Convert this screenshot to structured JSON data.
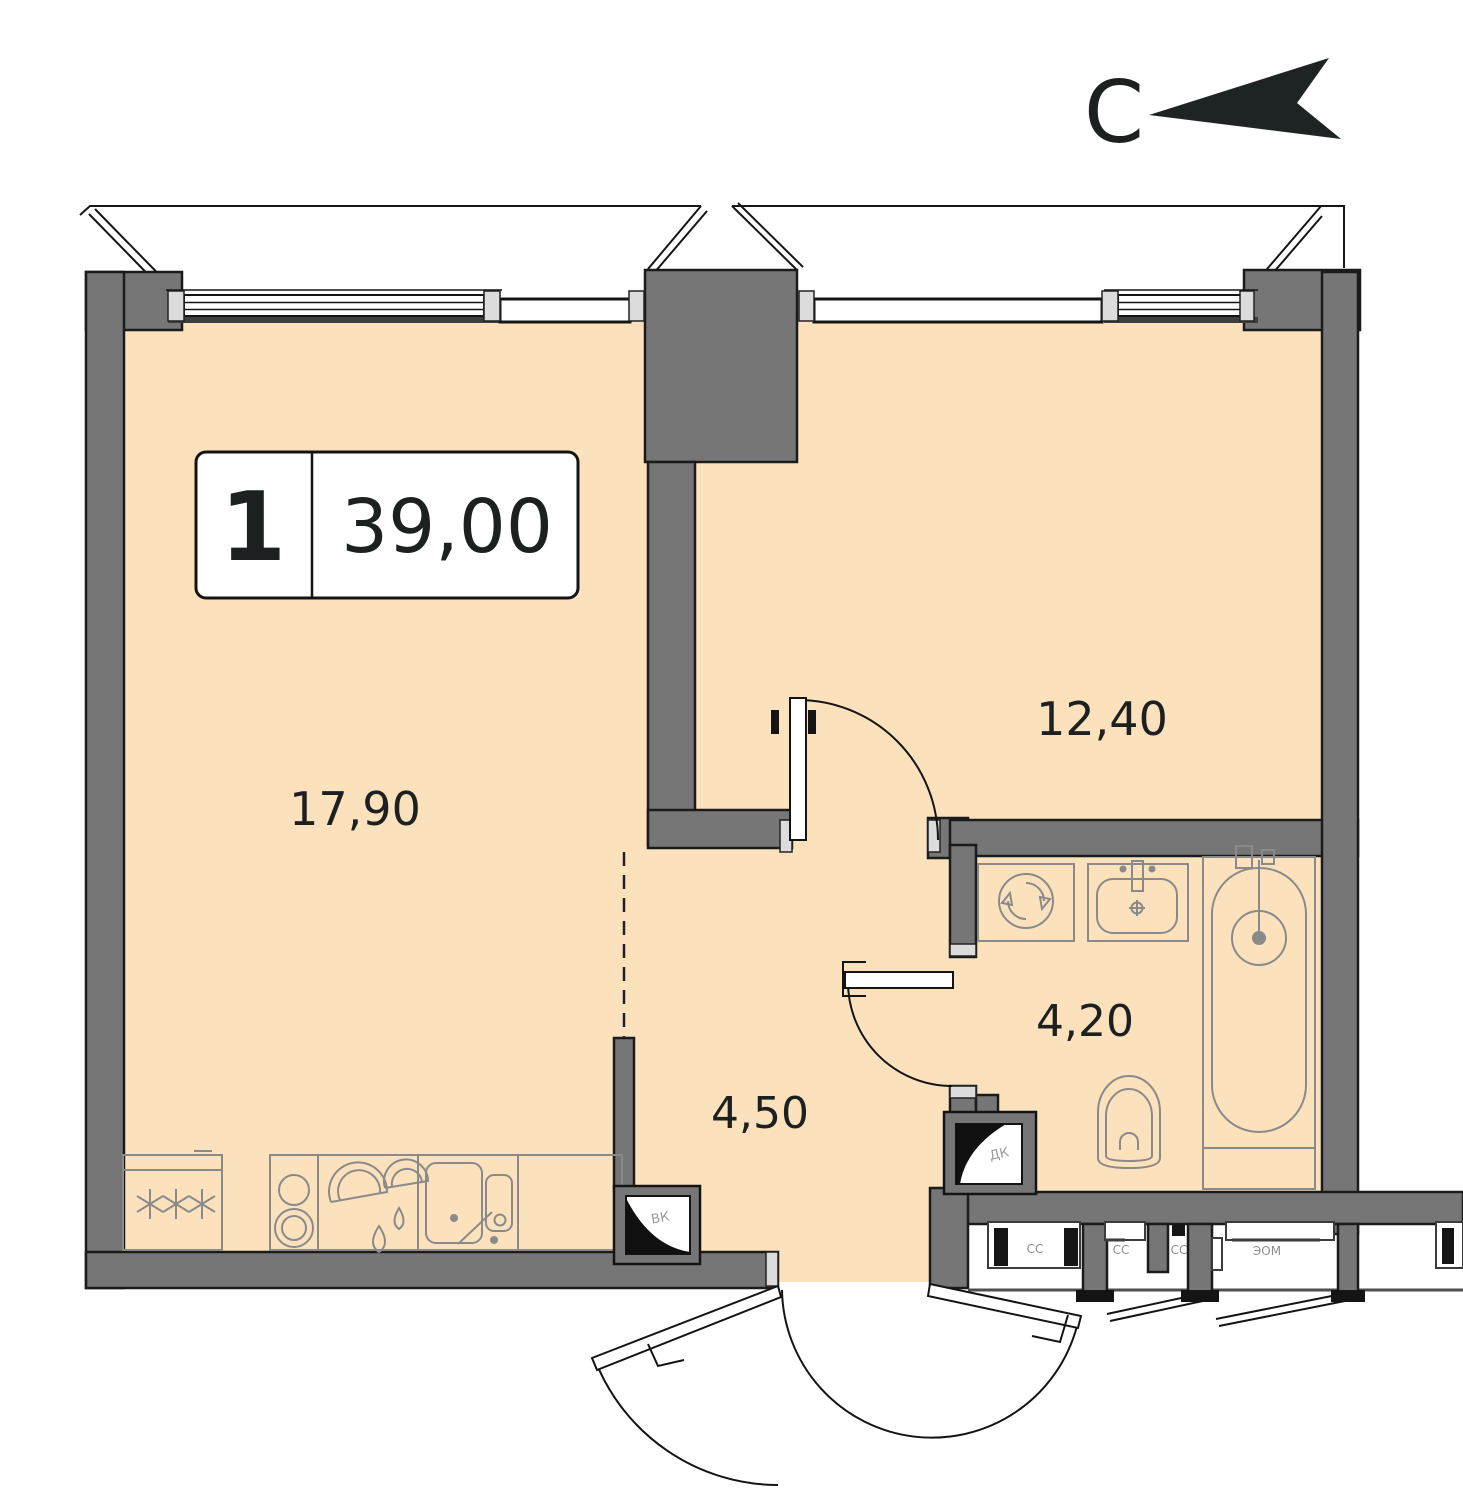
{
  "north_indicator": {
    "label": "С"
  },
  "unit_card": {
    "rooms": "1",
    "area": "39,00"
  },
  "room_areas": {
    "living_kitchen": "17,90",
    "bedroom": "12,40",
    "hallway": "4,50",
    "bathroom": "4,20"
  },
  "shafts": {
    "hallway": "ВК",
    "bathroom": "ДК"
  },
  "corridor_labels": {
    "n1": "СС",
    "n2": "СС",
    "n3": "СС",
    "n4": "ЭОМ"
  },
  "colors": {
    "floor": "#FBE2BD",
    "wall": "#767676",
    "outline": "#1b1b1b",
    "fixture_stroke": "#8a8a8a",
    "ink": "#1e2323"
  }
}
